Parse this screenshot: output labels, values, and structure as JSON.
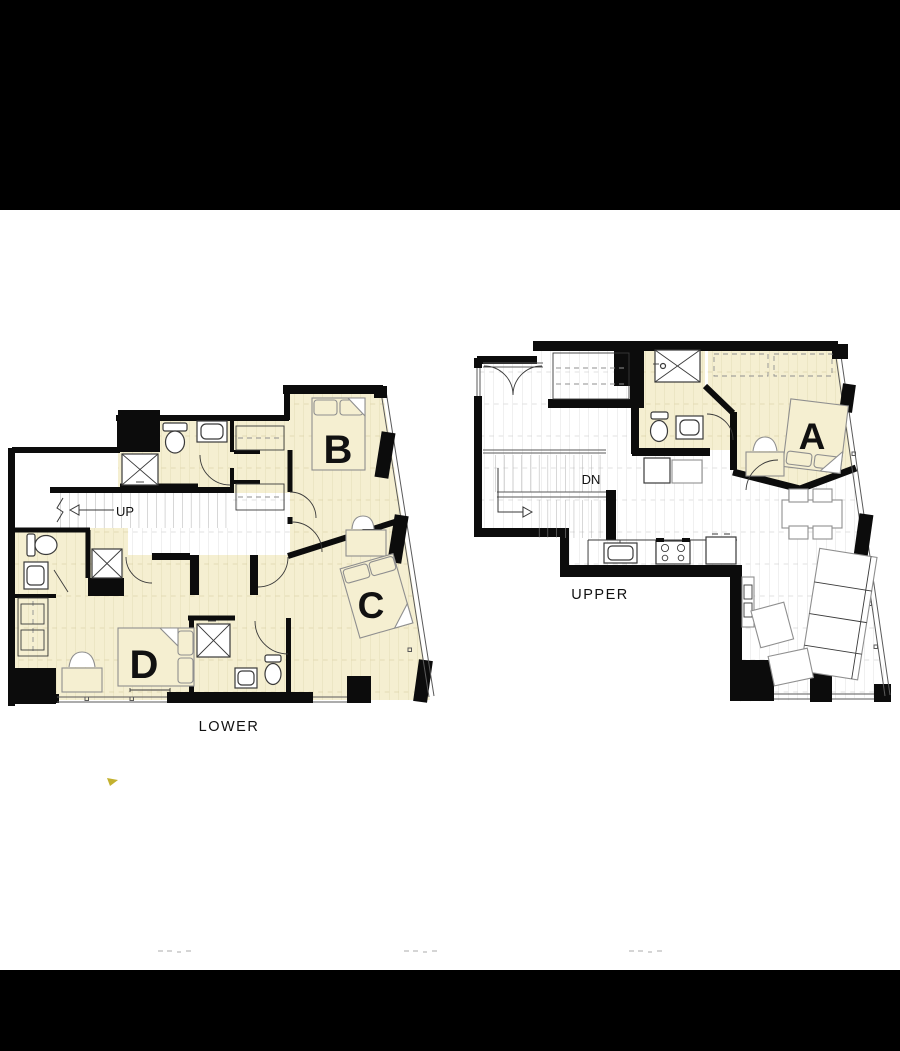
{
  "canvas": {
    "width": 900,
    "height": 1051
  },
  "bands": {
    "top_color": "#000000",
    "bottom_color": "#000000"
  },
  "colors": {
    "wall": "#0c0c0c",
    "cream": "#f5efd1",
    "floor_line": "#d6d6d6",
    "cream_line": "#ddd5ab",
    "furniture": "#8f8f8f",
    "fixture": "#3a3a3a",
    "stair_line": "#a8a8a8",
    "window": "#5a5a5a",
    "label": "#111111",
    "faint_mark": "#c7c7c7",
    "stray_mark": "#b9a30a"
  },
  "plans": {
    "lower": {
      "name_label": "LOWER",
      "stair_direction_label": "UP",
      "bedrooms": [
        {
          "label": "B"
        },
        {
          "label": "C"
        },
        {
          "label": "D"
        }
      ]
    },
    "upper": {
      "name_label": "UPPER",
      "stair_direction_label": "DN",
      "bedrooms": [
        {
          "label": "A"
        }
      ]
    }
  }
}
